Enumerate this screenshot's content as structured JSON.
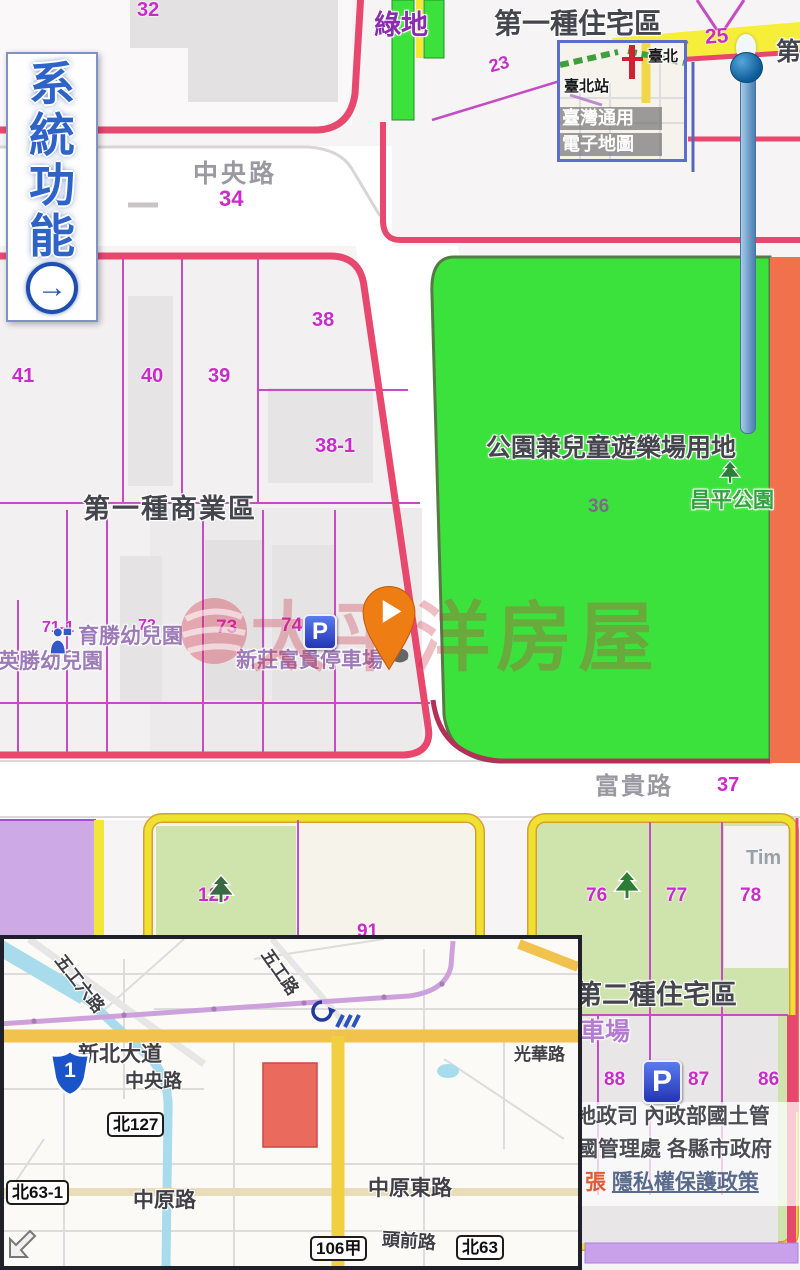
{
  "sidebar": {
    "chars": [
      "系",
      "統",
      "功",
      "能"
    ],
    "arrow_glyph": "→"
  },
  "layer_thumbnail": {
    "station_label": "臺北站",
    "caption_line1": "臺灣通用",
    "caption_line2": "電子地圖",
    "corner_label": "臺北"
  },
  "zone_labels": {
    "residential_type1": "第一種住宅區",
    "commercial_type1": "第一種商業區",
    "residential_type2": "第二種住宅區",
    "park_playground": "公園兼兒童遊樂場用地",
    "green_space": "綠地",
    "park_name": "昌平公園",
    "partial_zone_char": "第",
    "partial_tim": "Tim",
    "partial_parking": "車場"
  },
  "road_labels": {
    "zhongyang": "中央路",
    "fugui": "富貴路"
  },
  "parcels": {
    "p32": "32",
    "p25": "25",
    "p23": "23",
    "p34": "34",
    "p38": "38",
    "p41": "41",
    "p40": "40",
    "p39": "39",
    "p38_1": "38-1",
    "p36": "36",
    "p37": "37",
    "p71_1": "71-1",
    "p72": "72",
    "p73": "73",
    "p74": "74",
    "p91": "91",
    "p120": "120",
    "p76": "76",
    "p77": "77",
    "p78": "78",
    "p88": "88",
    "p87": "87",
    "p86": "86"
  },
  "pois": {
    "kindergarten_yusheng": "育勝幼兒園",
    "kindergarten_yingsheng": "英勝幼兒園",
    "parking_name": "新莊富貴停車場",
    "parking_glyph": "P"
  },
  "watermark": {
    "brand": "太平洋房屋"
  },
  "attribution": {
    "line1": "地政司 內政部國土管",
    "line2": "國管理處 各縣市政府",
    "line3_prefix": "張",
    "privacy_link": "隱私權保護政策"
  },
  "inset_map": {
    "roads": {
      "wugong6": "五工六路",
      "wugong": "五工路",
      "xinbei_blvd": "新北大道",
      "zhongyang": "中央路",
      "guanghua": "光華路",
      "zhongyuan": "中原路",
      "zhongyuan_east": "中原東路",
      "touqian": "頭前路"
    },
    "badges": {
      "b127": "北127",
      "b63_1": "北63-1",
      "b106": "106甲",
      "b63": "北63"
    },
    "highway_number": "1"
  },
  "colors": {
    "parcel_magenta": "#c92cc9",
    "zone_border_red": "#e8486e",
    "park_green": "#3ce23c",
    "residential_light_green": "#cfe4ad",
    "yellow_border": "#f0e030",
    "orange_strip": "#f1714d",
    "purple_block": "#cdaae6",
    "watermark_red": "#cc2a3e",
    "slider_blue": "#6b9cc8",
    "sidebar_blue": "#2e63c8"
  }
}
